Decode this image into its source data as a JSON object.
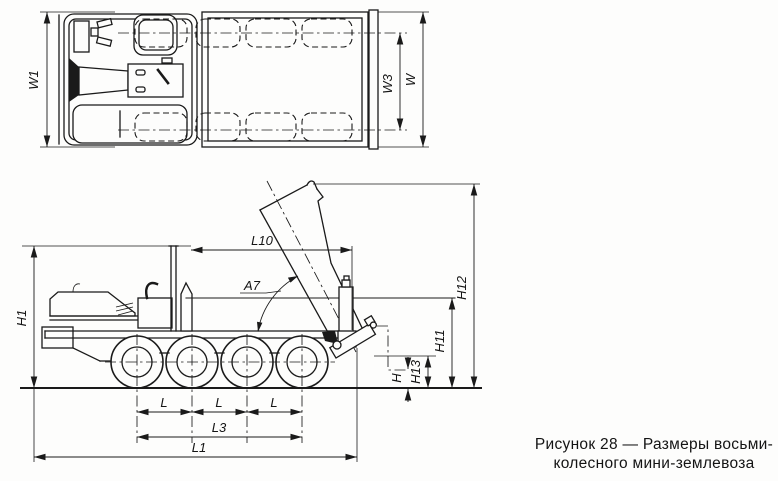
{
  "figure": {
    "caption": {
      "line1": "Рисунок 28 — Размеры восьми-",
      "line2": "колесного мини-землевоза"
    }
  },
  "dims": {
    "w1": "W1",
    "w3": "W3",
    "w": "W",
    "h1": "H1",
    "l10": "L10",
    "a7": "A7",
    "h12": "H12",
    "h11": "H11",
    "h13": "H13",
    "h": "H",
    "l": "L",
    "l3": "L3",
    "l1": "L1"
  }
}
